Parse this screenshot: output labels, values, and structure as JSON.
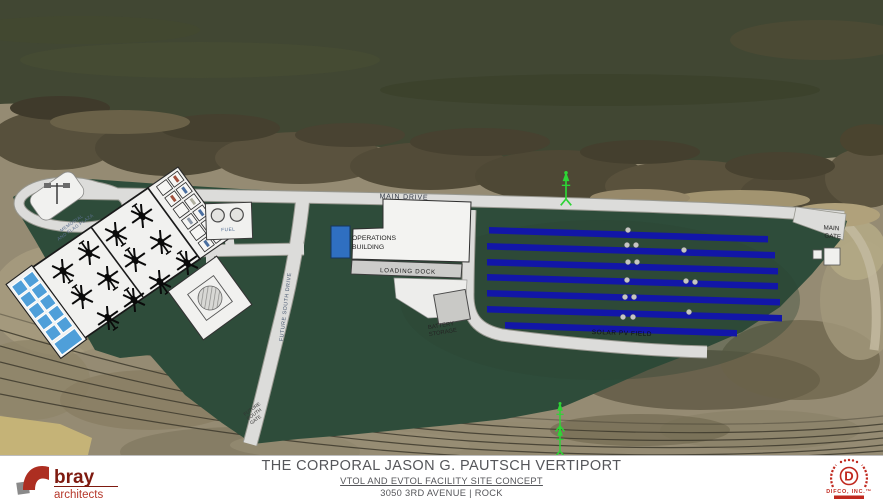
{
  "plan": {
    "labels": {
      "main_drive": "MAIN DRIVE",
      "main_gate_line1": "MAIN",
      "main_gate_line2": "GATE",
      "operations_line1": "OPERATIONS",
      "operations_line2": "BUILDING",
      "loading_dock": "LOADING DOCK",
      "fuel": "FUEL",
      "south_drive": "FUTURE SOUTH DRIVE",
      "south_gate_line1": "FUTURE",
      "south_gate_line2": "SOUTH",
      "south_gate_line3": "GATE",
      "battery_line1": "BATTERY",
      "battery_line2": "STORAGE",
      "solar": "SOLAR PV FIELD",
      "memorial_line1": "MEMORIAL",
      "memorial_line2": "AND FLAG PLAZA"
    },
    "colors": {
      "site_green": "#2e4c3a",
      "solar_blue": "#1216a8",
      "charger_blue": "#4f9fd9",
      "ops_blue": "#2f6fc1",
      "road": "#dcdcda",
      "windsock_green": "#2dd435"
    }
  },
  "title_block": {
    "title": "THE CORPORAL JASON G. PAUTSCH VERTIPORT",
    "subtitle": "VTOL AND EVTOL FACILITY SITE CONCEPT",
    "address": "3050 3RD AVENUE | ROCK"
  },
  "logos": {
    "bray": {
      "name": "bray",
      "tagline": "architects"
    },
    "difco": {
      "monogram": "D",
      "name": "DIFCO, INC.™"
    }
  }
}
